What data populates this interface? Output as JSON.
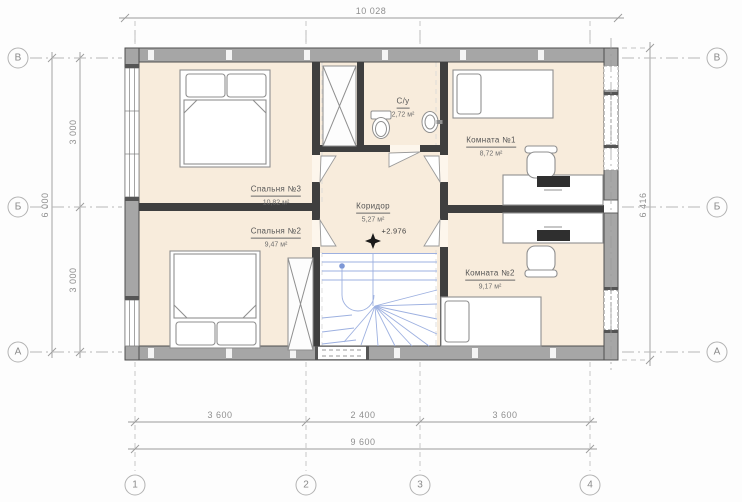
{
  "rooms": [
    {
      "name": "Спальня №3",
      "area": "10,82 м²"
    },
    {
      "name": "Спальня №2",
      "area": "9,47 м²"
    },
    {
      "name": "С/у",
      "area": "2,72 м²"
    },
    {
      "name": "Коридор",
      "area": "5,27 м²"
    },
    {
      "name": "Комната №1",
      "area": "8,72 м²"
    },
    {
      "name": "Комната №2",
      "area": "9,17 м²"
    }
  ],
  "elevation_mark": "+2.976",
  "dimensions": {
    "top_overall": "10 028",
    "left_overall": "6 000",
    "left_segments": [
      "3 000",
      "3 000"
    ],
    "right_overall": "6 416",
    "bottom_segments": [
      "3 600",
      "2 400",
      "3 600"
    ],
    "bottom_overall": "9 600"
  },
  "axes": {
    "rows": [
      "В",
      "Б",
      "А"
    ],
    "cols": [
      "1",
      "2",
      "3",
      "4"
    ]
  },
  "colors": {
    "floor": "#f8ecdc",
    "exterior_wall": "#a6a6a6",
    "interior_wall": "#3f3f3f",
    "stairs": "#9db0e0",
    "dimension": "#9a9a9a"
  }
}
